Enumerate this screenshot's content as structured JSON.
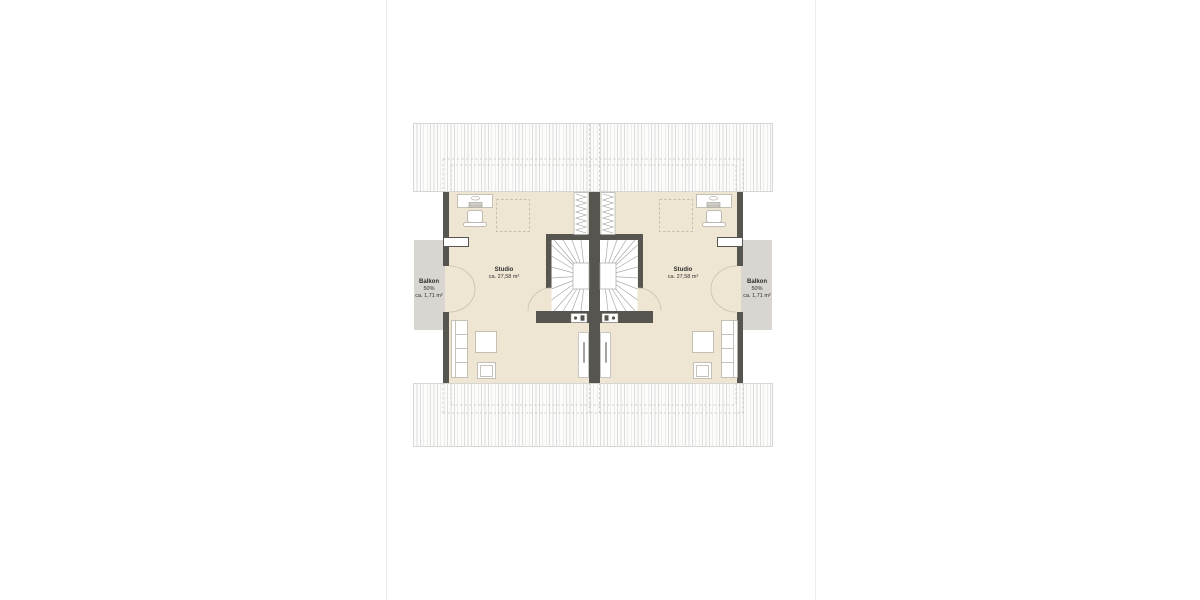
{
  "plan": {
    "units": {
      "left": {
        "room_label": "Studio",
        "room_area": "ca. 27,58 m²",
        "balcony_label": "Balkon",
        "balcony_share": "50%",
        "balcony_area": "ca. 1,71 m²"
      },
      "right": {
        "room_label": "Studio",
        "room_area": "ca. 27,58 m²",
        "balcony_label": "Balkon",
        "balcony_share": "50%",
        "balcony_area": "ca. 1,71 m²"
      }
    },
    "colors": {
      "floor_fill": "#eee6d2",
      "wall_fill": "#57554f",
      "balcony_fill": "#d9d6d1",
      "roof_hatch_line": "#dddddc",
      "dashed_line": "#c2beb4",
      "furniture_outline": "#b7b3a9",
      "stair_tread_line": "#a9a9a5"
    },
    "icons": [
      "desk-icon",
      "office-chair-icon",
      "rooflight-dashed-icon",
      "loft-ladder-icon",
      "stair-icon",
      "balcony-door-swing-icon",
      "stair-door-swing-icon",
      "roof-window-icon",
      "sofa-icon",
      "coffee-table-icon",
      "armchair-icon",
      "window-icon"
    ]
  }
}
